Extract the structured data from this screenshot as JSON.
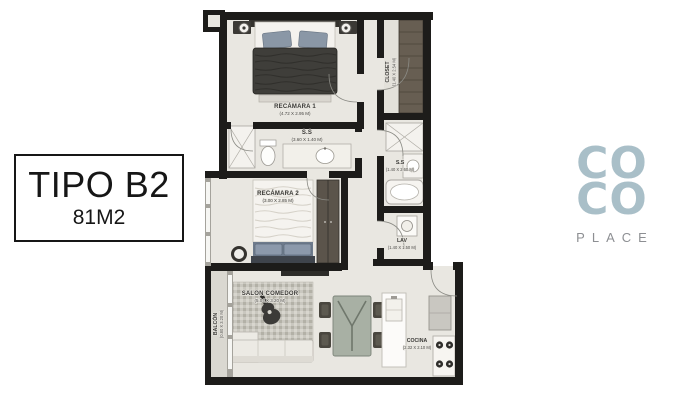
{
  "info_box": {
    "type_label": "TIPO B2",
    "area_label": "81M2"
  },
  "logo": {
    "line1": "CO",
    "line2": "CO",
    "subtitle": "PLACE",
    "brand_color": "#a9bfc8",
    "subtitle_color": "#8d8f93"
  },
  "floor_plan": {
    "wall_color": "#1d1c1a",
    "floor_color": "#e9e7e1",
    "rooms": [
      {
        "name": "RECÁMARA 1",
        "dims": "(4.72 X 2.95 M)"
      },
      {
        "name": "CLOSET",
        "dims": "(1.40 X 2.54 M)"
      },
      {
        "name": "S.S",
        "dims": "(3.60 X 1.40 M)"
      },
      {
        "name": "S.S",
        "dims": "(1.40 X 2.60 M)"
      },
      {
        "name": "LAV",
        "dims": "(1.40 X 1.50 M)"
      },
      {
        "name": "RECÁMARA 2",
        "dims": "(3.00 X 2.85 M)"
      },
      {
        "name": "BALCÓN",
        "dims": "(0.80 X 3.20 M)"
      },
      {
        "name": "SALON COMEDOR",
        "dims": "(5.04 X 3.20 M)"
      },
      {
        "name": "COCINA",
        "dims": "(2.32 X 2.10 M)"
      }
    ]
  }
}
